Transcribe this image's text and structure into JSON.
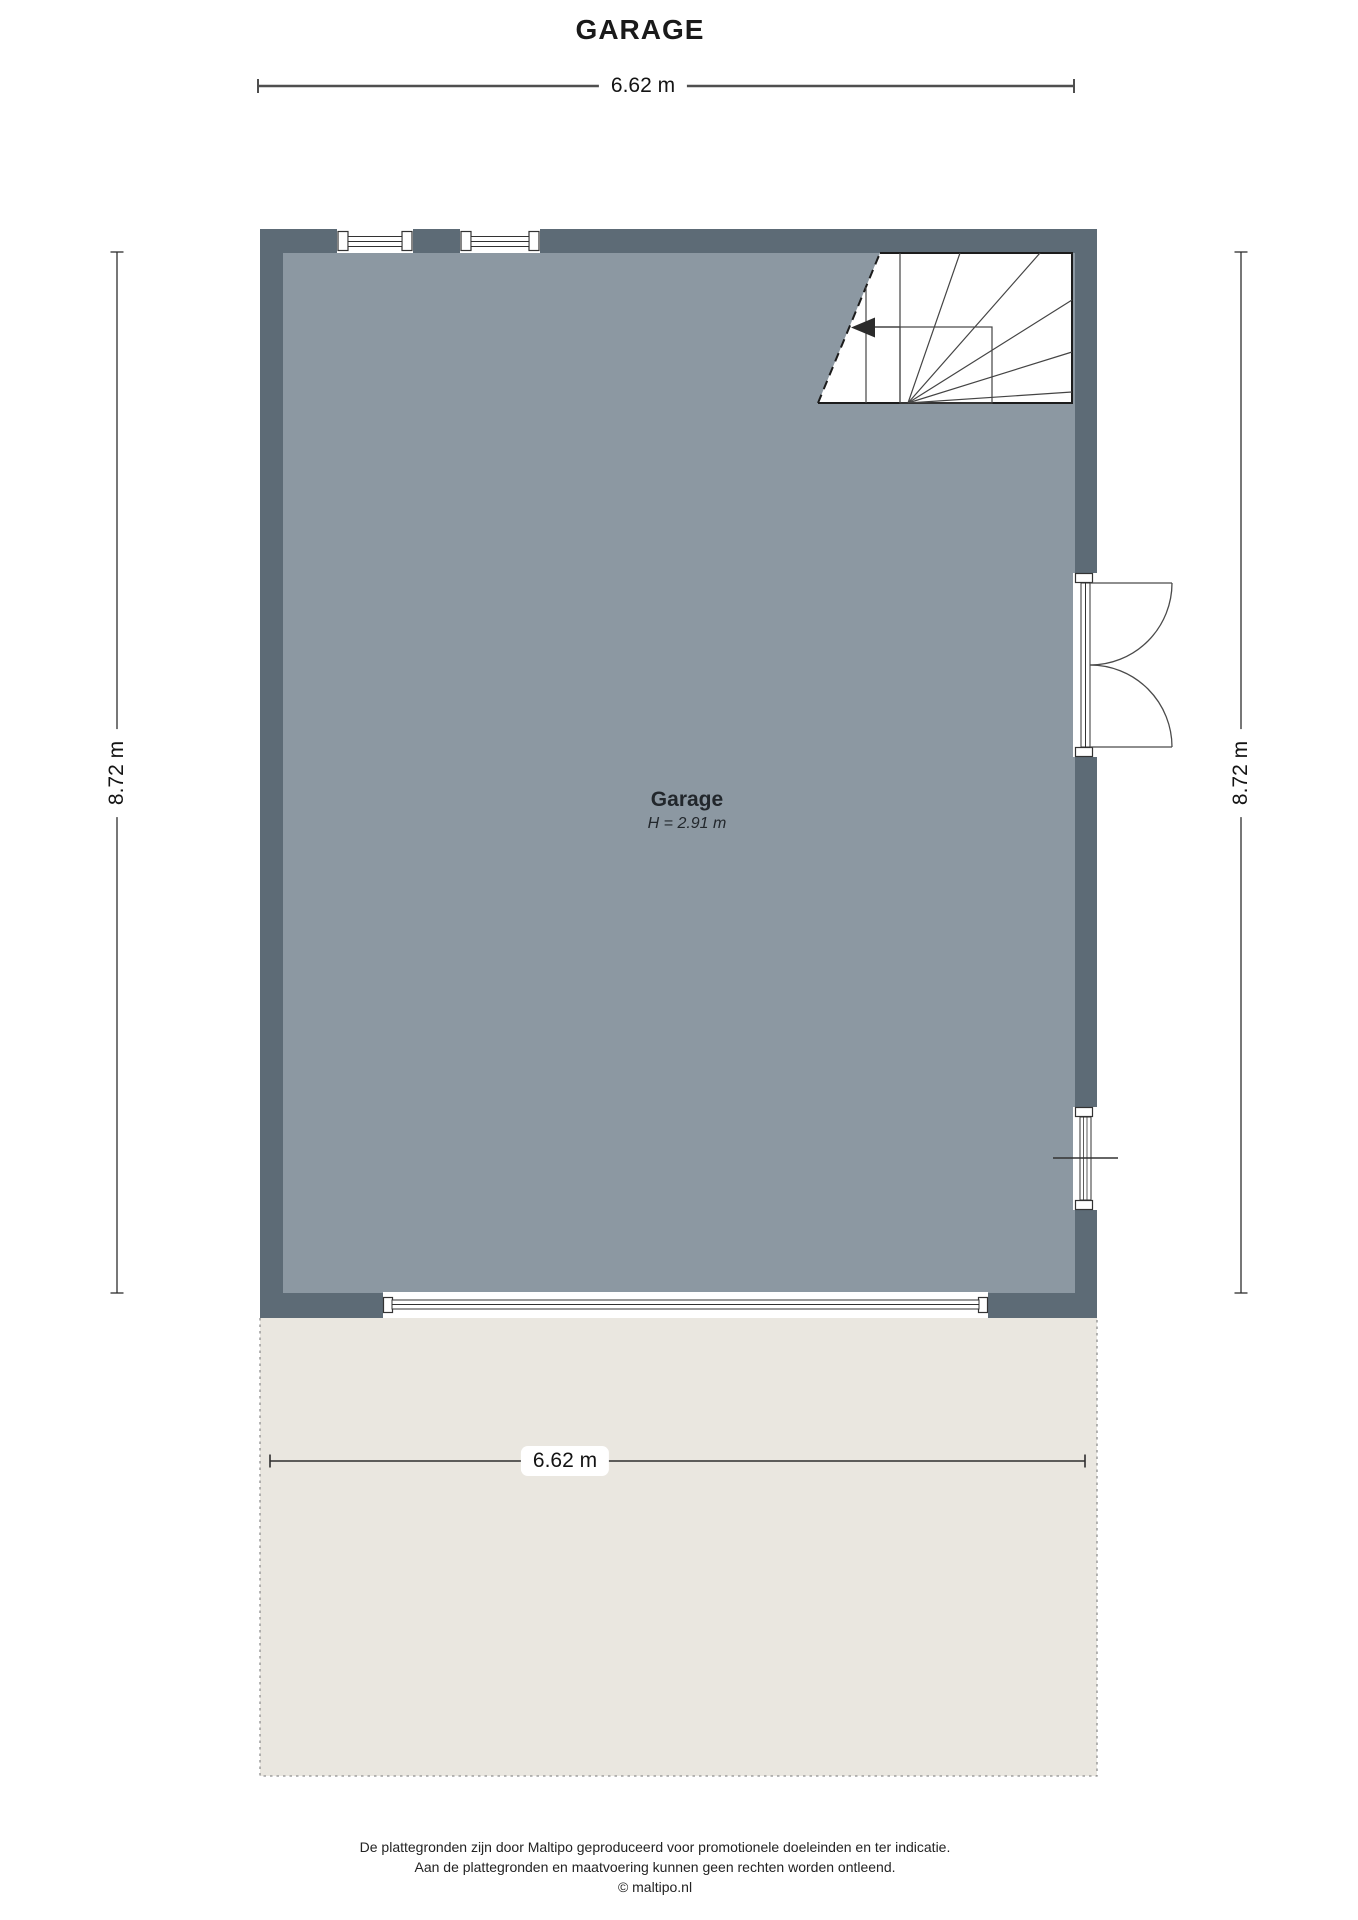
{
  "title": "GARAGE",
  "plan": {
    "room_label": "Garage",
    "room_height": "H = 2.91 m",
    "dim_top": "6.62 m",
    "dim_bottom": "6.62 m",
    "dim_left": "8.72 m",
    "dim_right": "8.72 m",
    "colors": {
      "wall": "#5d6b76",
      "floor": "#8c98a2",
      "terrace": "#eae7e0",
      "outline": "#2e2e2e"
    }
  },
  "footer": {
    "line1": "De plattegronden zijn door Maltipo geproduceerd voor promotionele doeleinden en ter indicatie.",
    "line2": "Aan de plattegronden en maatvoering kunnen geen rechten worden ontleend.",
    "line3": "© maltipo.nl"
  }
}
